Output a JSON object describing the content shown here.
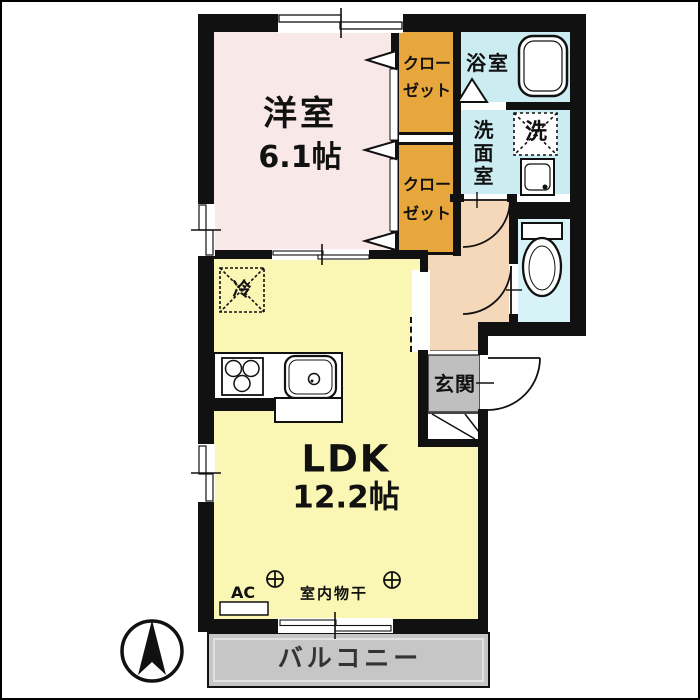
{
  "rooms": {
    "western": {
      "label": "洋室",
      "size": "6.1帖"
    },
    "closet1": {
      "line1": "クロー",
      "line2": "ゼット"
    },
    "closet2": {
      "line1": "クロー",
      "line2": "ゼット"
    },
    "bath": {
      "label": "浴室"
    },
    "washroom": {
      "label": "洗面室"
    },
    "entrance": {
      "label": "玄関"
    },
    "ldk": {
      "label": "LDK",
      "size": "12.2帖"
    },
    "balcony": {
      "label": "バルコニー"
    }
  },
  "fixtures": {
    "washer": {
      "label": "洗"
    },
    "refrigerator": {
      "label": "冷"
    },
    "ac": {
      "label": "AC"
    },
    "laundry": {
      "label": "室内物干"
    }
  },
  "icons": {
    "compass": "north-arrow",
    "bathtub": "bathtub-icon",
    "toilet": "toilet-icon",
    "washbasin": "washbasin-icon",
    "stove": "stove-icon",
    "sink": "sink-icon",
    "laundry_hook": "circle-cross-hook-icon"
  },
  "colors": {
    "western_room_fill": "#F8E8E8",
    "closet_fill": "#E8A73C",
    "wet_area_fill": "#CBEDF1",
    "toilet_fill": "#D8F3F8",
    "hallway_fill": "#F5D7BA",
    "ldk_fill": "#FAF6B4",
    "entrance_fill": "#BFBFBF",
    "balcony_fill": "#C6C6C6",
    "wall_color": "#111111"
  }
}
